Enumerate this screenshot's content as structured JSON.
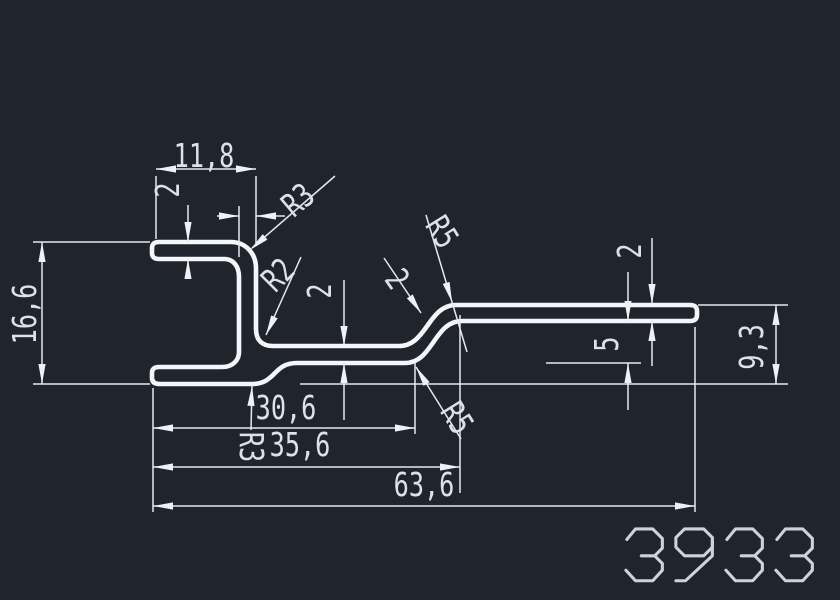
{
  "drawing": {
    "type": "profile-cross-section",
    "part_number": "3933",
    "colors": {
      "background": "#20242c",
      "profile_line": "#f4f6f9",
      "dimension_line": "#e6eaef",
      "text": "#dde2e8"
    },
    "labels": {
      "top_width": "11,8",
      "top_thickness": "2",
      "radius_top_outer": "R3",
      "radius_inner": "R2",
      "mid_web_thickness": "2",
      "diagonal_thickness": "2",
      "radius_s_upper": "R5",
      "right_arm_thickness": "2",
      "right_offset": "5",
      "right_height": "9,3",
      "total_height": "16,6",
      "length_to_bend": "30,6",
      "radius_bottom": "R3",
      "length_to_arm": "35,6",
      "total_length": "63,6",
      "radius_s_lower": "R5"
    }
  }
}
